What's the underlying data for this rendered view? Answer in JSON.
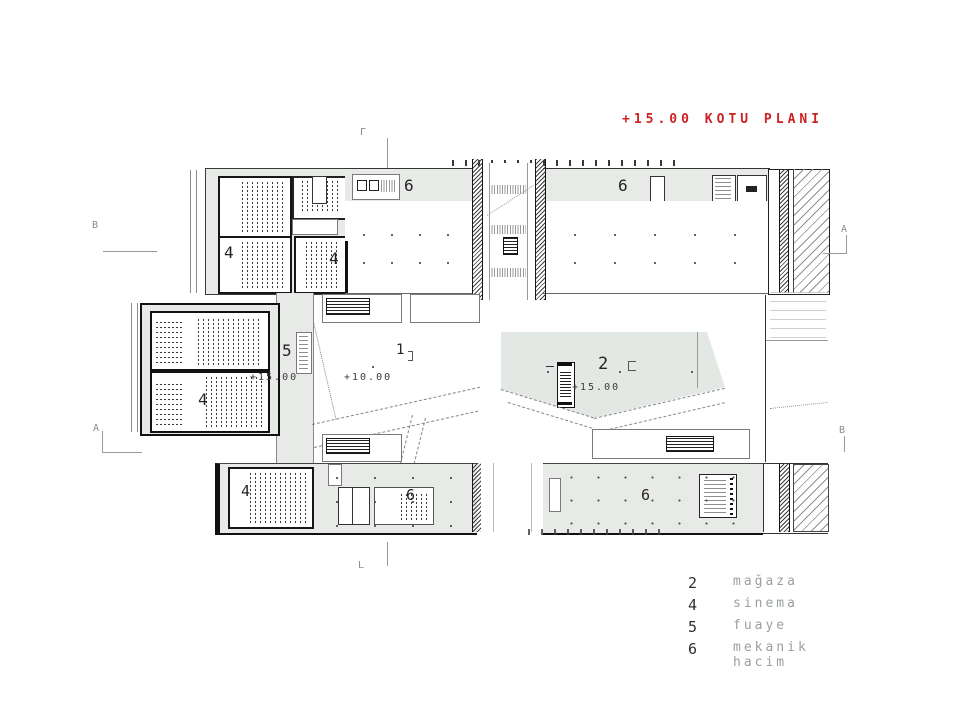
{
  "title": "+15.00 KOTU PLANI",
  "title_color": "#cf2121",
  "legend": {
    "items": [
      {
        "number": "2",
        "label": "mağaza"
      },
      {
        "number": "4",
        "label": "sinema"
      },
      {
        "number": "5",
        "label": "fuaye"
      },
      {
        "number": "6",
        "label": "mekanik hacim"
      }
    ]
  },
  "plan": {
    "rooms": {
      "mech_top_left": "6",
      "mech_top_right": "6",
      "cinema_top_a": "4",
      "cinema_top_b": "4",
      "cinema_mid": "4",
      "foyer": "5",
      "atrium": "1",
      "shop": "2",
      "cinema_bottom": "4",
      "mech_bottom_left": "6",
      "mech_bottom_right": "6"
    },
    "elevations": {
      "foyer": "+15.00",
      "atrium": "+10.00",
      "shop": "+15.00"
    },
    "marks": {
      "left_top": "B",
      "left_bottom": "A",
      "right_top": "A",
      "right_bottom": "B",
      "top": "Γ",
      "bottom": "L"
    }
  }
}
